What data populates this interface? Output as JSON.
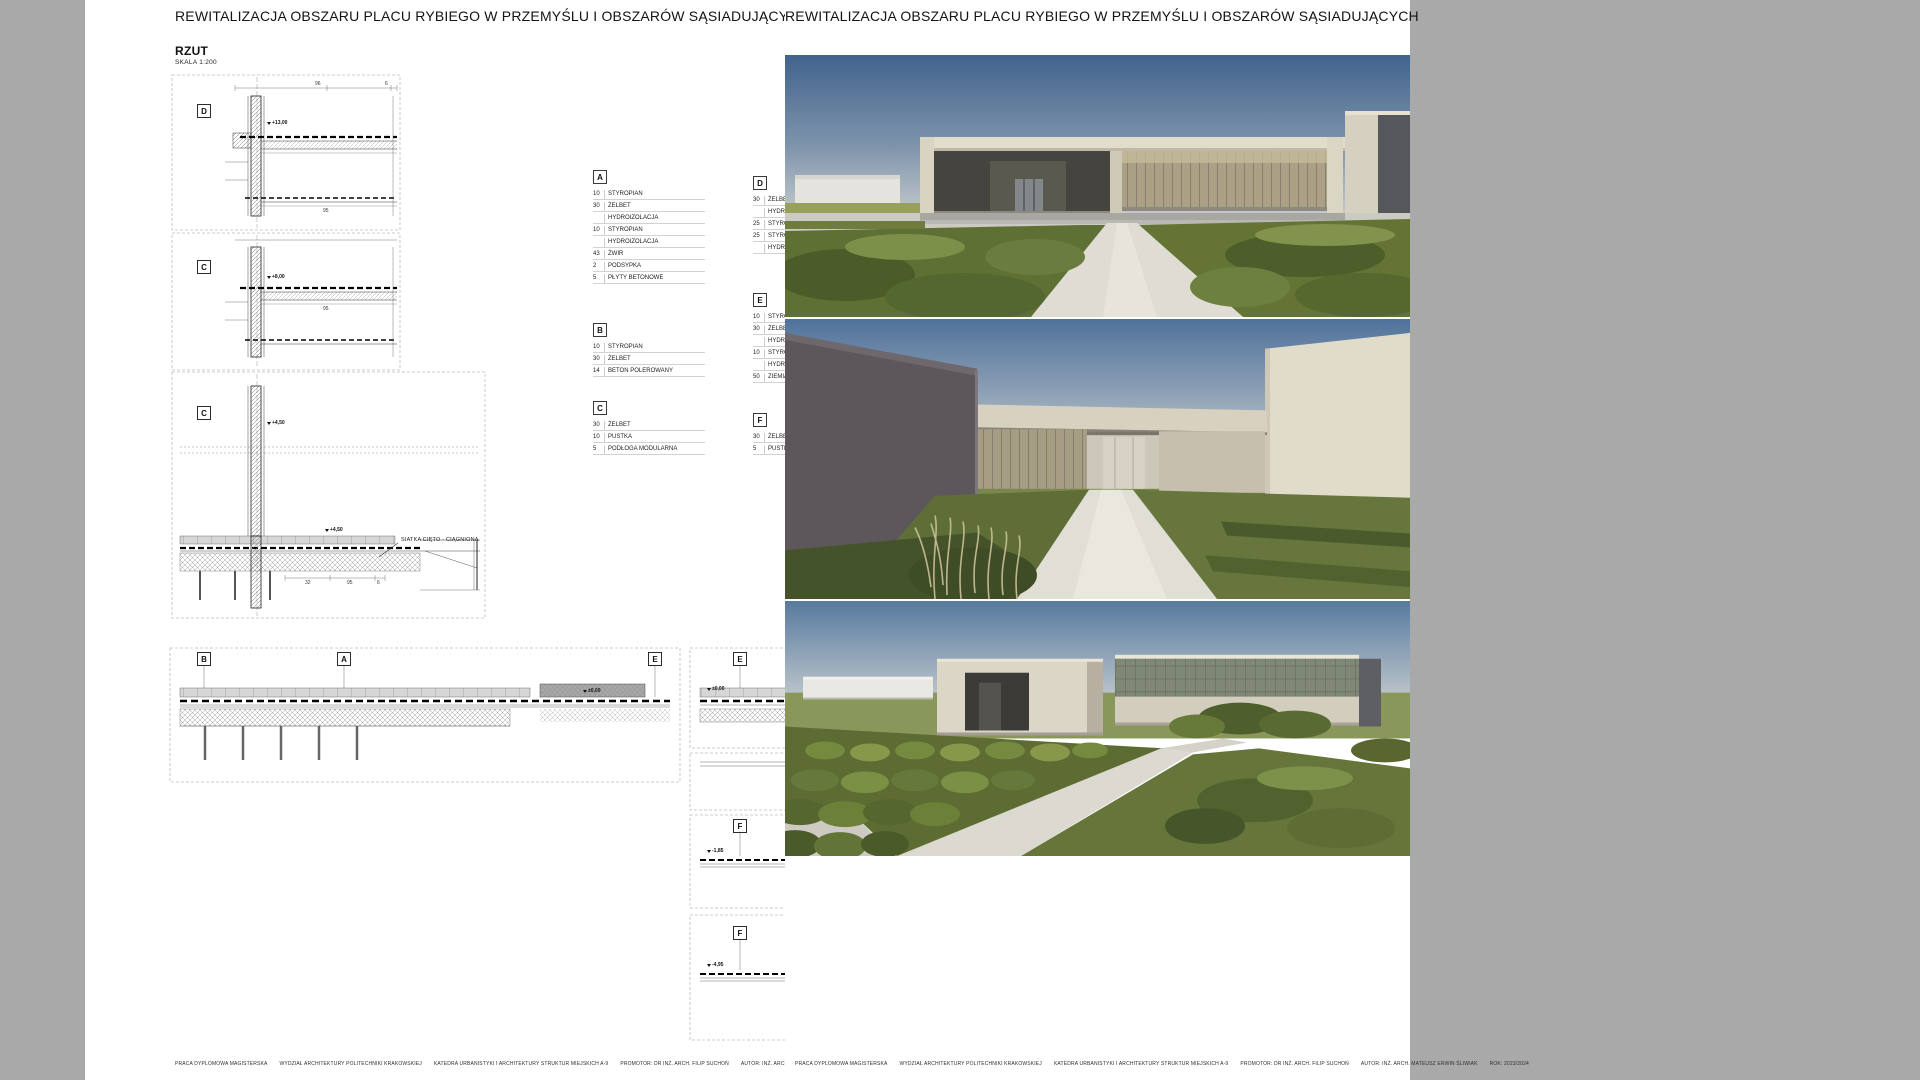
{
  "palette": {
    "canvas_bg": "#a9a9a9",
    "board_bg": "#ffffff",
    "ink": "#1a1a1a",
    "dash_frame": "#bcbcbc",
    "sky_top": "#41638c",
    "sky_horizon": "#c9cdce",
    "building_cream": "#d8d2c1",
    "building_dark": "#57575b",
    "grass_dark": "#4c5c28",
    "grass_mid": "#5f7034",
    "grass_light": "#8b9c55",
    "path_light": "#dedcd3"
  },
  "titles": {
    "left": "REWITALIZACJA OBSZARU PLACU RYBIEGO W PRZEMYŚLU I OBSZARÓW SĄSIADUJĄCYCH",
    "right": "REWITALIZACJA OBSZARU PLACU RYBIEGO W PRZEMYŚLU I OBSZARÓW SĄSIADUJĄCYCH"
  },
  "plan": {
    "name": "RZUT",
    "scale": "SKALA 1:200",
    "note": "SIATKA CIĘTO - CIĄGNIONA",
    "labels": {
      "d1": "D",
      "c1": "C",
      "c2": "C",
      "b": "B",
      "a": "A",
      "e1": "E",
      "e2": "E",
      "f1": "F",
      "f2": "F"
    },
    "marks": {
      "d1": "+13,00",
      "c1": "+8,00",
      "c2": "+4,50",
      "c2b": "+4,50",
      "wide": "±0,00",
      "e2": "±0,00",
      "f1": "-1,85",
      "f2": "-4,95"
    },
    "dims": {
      "d1a": "96",
      "d1b": "6",
      "d1c": "95",
      "c1a": "95",
      "c2a": "32",
      "c2b": "95",
      "c2c": "6"
    }
  },
  "legends": [
    {
      "id": "A",
      "rows": [
        {
          "t": "10",
          "m": "STYROPIAN"
        },
        {
          "t": "30",
          "m": "ŻELBET"
        },
        {
          "t": "",
          "m": "HYDROIZOLACJA"
        },
        {
          "t": "10",
          "m": "STYROPIAN"
        },
        {
          "t": "",
          "m": "HYDROIZOLACJA"
        },
        {
          "t": "43",
          "m": "ŻWIR"
        },
        {
          "t": "2",
          "m": "PODSYPKA"
        },
        {
          "t": "5",
          "m": "PŁYTY BETONOWE"
        }
      ]
    },
    {
      "id": "B",
      "rows": [
        {
          "t": "10",
          "m": "STYROPIAN"
        },
        {
          "t": "30",
          "m": "ŻELBET"
        },
        {
          "t": "14",
          "m": "BETON POLEROWANY"
        }
      ]
    },
    {
      "id": "C",
      "rows": [
        {
          "t": "30",
          "m": "ŻELBET"
        },
        {
          "t": "10",
          "m": "PUSTKA"
        },
        {
          "t": "5",
          "m": "PODŁOGA MODULARNA"
        }
      ]
    },
    {
      "id": "D",
      "rows": [
        {
          "t": "30",
          "m": "ŻELBET"
        },
        {
          "t": "",
          "m": "HYDROIZOLACJA"
        },
        {
          "t": "25",
          "m": "STYROPIAN"
        },
        {
          "t": "25",
          "m": "STYROPIAN"
        },
        {
          "t": "",
          "m": "HYDROIZOLACJA"
        }
      ]
    },
    {
      "id": "E",
      "rows": [
        {
          "t": "10",
          "m": "STYROPIAN"
        },
        {
          "t": "30",
          "m": "ŻELBET"
        },
        {
          "t": "",
          "m": "HYDROIZOLACJA"
        },
        {
          "t": "10",
          "m": "STYROPIAN"
        },
        {
          "t": "",
          "m": "HYDROIZOLACJA"
        },
        {
          "t": "50",
          "m": "ZIEMIA"
        }
      ]
    },
    {
      "id": "F",
      "rows": [
        {
          "t": "30",
          "m": "ŻELBET"
        },
        {
          "t": "5",
          "m": "PUSTKA"
        }
      ]
    }
  ],
  "footer": {
    "i1": "PRACA DYPLOMOWA MAGISTERSKA",
    "i2": "WYDZIAŁ ARCHITEKTURY POLITECHNIKI KRAKOWSKIEJ",
    "i3": "KATEDRA URBANISTYKI I ARCHITEKTURY STRUKTUR MIEJSKICH A-9",
    "i4": "PROMOTOR: DR INŻ. ARCH. FILIP SUCHOŃ",
    "i5": "AUTOR: INŻ. ARCH. MATEUSZ ERWIN ŚLIWIAK",
    "i6": "ROK: 2023/2024"
  }
}
